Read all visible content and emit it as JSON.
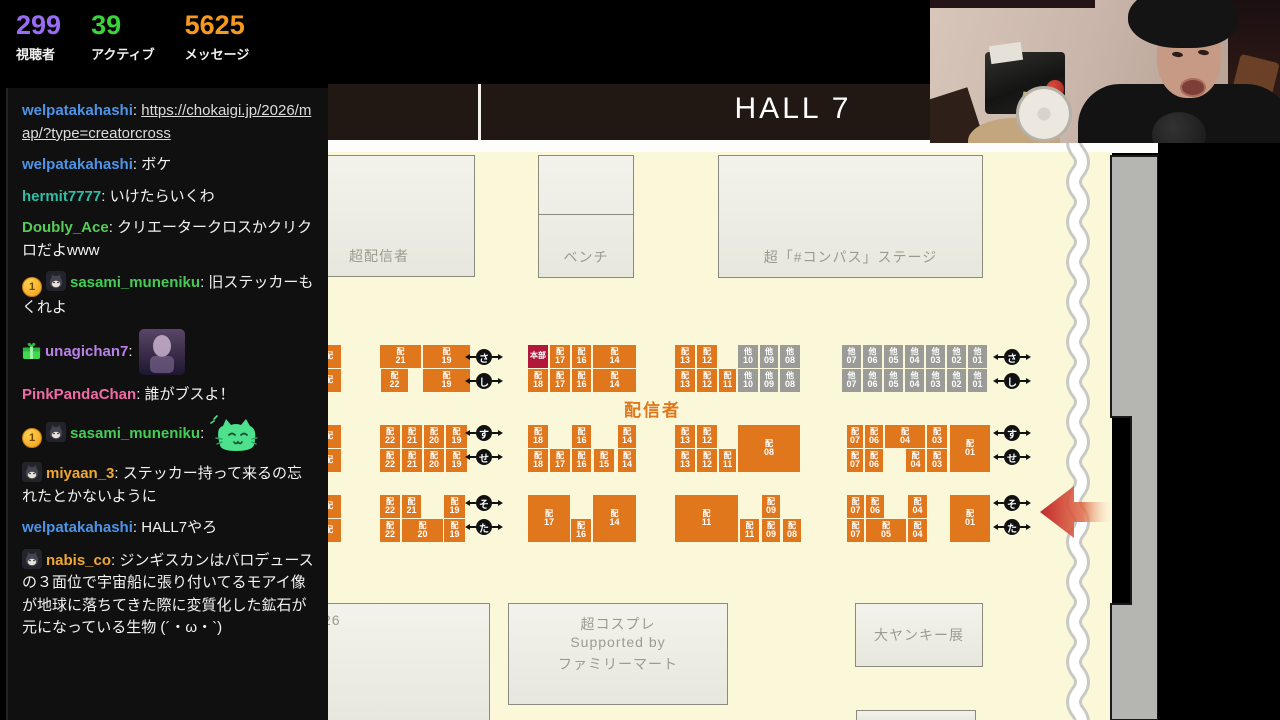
{
  "stats": {
    "viewers": "299",
    "viewers_label": "視聴者",
    "viewers_color": "#9a6cf5",
    "active": "39",
    "active_label": "アクティブ",
    "active_color": "#38d438",
    "messages": "5625",
    "messages_label": "メッセージ",
    "messages_color": "#f59a1e"
  },
  "chat": {
    "messages": [
      {
        "user": "welpatakahashi",
        "color": "#4d94e8",
        "link": "https://chokaigi.jp/2026/map/?type=creatorcross"
      },
      {
        "user": "welpatakahashi",
        "color": "#4d94e8",
        "text": "ボケ"
      },
      {
        "user": "hermit7777",
        "color": "#2fbfa6",
        "text": "いけたらいくわ"
      },
      {
        "user": "Doubly_Ace",
        "color": "#55cc55",
        "text": "クリエータークロスかクリクロだよwww"
      },
      {
        "user": "sasami_muneniku",
        "color": "#44cc55",
        "badges": [
          "coin",
          "cat"
        ],
        "text": "旧ステッカーもくれよ"
      },
      {
        "user": "unagichan7",
        "color": "#b982e6",
        "badges": [
          "gift"
        ],
        "emote": "purple"
      },
      {
        "user": "PinkPandaChan",
        "color": "#f06ba8",
        "text": "誰がブスよ！"
      },
      {
        "user": "sasami_muneniku",
        "color": "#44cc55",
        "badges": [
          "coin",
          "cat"
        ],
        "emote": "greencat"
      },
      {
        "user": "miyaan_3",
        "color": "#f0a832",
        "badges": [
          "cat"
        ],
        "text": "ステッカー持って来るの忘れたとかないように"
      },
      {
        "user": "welpatakahashi",
        "color": "#4d94e8",
        "text": "HALL7やろ"
      },
      {
        "user": "nabis_co",
        "color": "#f0a832",
        "badges": [
          "cat"
        ],
        "text": "ジンギスカンはパロデュースの３面位で宇宙船に張り付いてるモアイ像が地球に落ちてきた際に変質化した鉱石が元になっている生物 (´・ω・`)"
      }
    ],
    "coin_badge_label": "1"
  },
  "map": {
    "hall_title": "HALL 7",
    "haishinsha_label": "配信者",
    "colors": {
      "booth_orange": "#e0771c",
      "booth_gray": "#9b9b97",
      "hq_red": "#b2173a",
      "floor_cream": "#faf8d9"
    },
    "areas": [
      {
        "x": -12,
        "y": 155,
        "w": 159,
        "h": 122,
        "lines": [
          "超配信者"
        ],
        "pos": "bl"
      },
      {
        "x": 210,
        "y": 155,
        "w": 96,
        "h": 123,
        "lines": [
          "ベンチ"
        ],
        "pos": "bc",
        "divider": 58
      },
      {
        "x": 390,
        "y": 155,
        "w": 265,
        "h": 123,
        "lines": [
          "超「#コンパス」ステージ"
        ],
        "pos": "bc"
      },
      {
        "x": -12,
        "y": 603,
        "w": 174,
        "h": 120,
        "lines": [
          "26"
        ],
        "pos": "tl"
      },
      {
        "x": 180,
        "y": 603,
        "w": 220,
        "h": 102,
        "lines": [
          "超コスプレ",
          "Supported by",
          "ファミリーマート"
        ],
        "pos": "tc"
      },
      {
        "x": 527,
        "y": 603,
        "w": 128,
        "h": 64,
        "lines": [
          "大ヤンキー展"
        ],
        "pos": "c"
      },
      {
        "x": 528,
        "y": 710,
        "w": 120,
        "h": 14,
        "lines": [],
        "pos": "c"
      }
    ],
    "booths": [
      {
        "x": -11,
        "y": 345,
        "w": 24,
        "h": 23,
        "p": "配",
        "n": "",
        "t": "o"
      },
      {
        "x": -11,
        "y": 369,
        "w": 24,
        "h": 23,
        "p": "配",
        "n": "",
        "t": "o"
      },
      {
        "x": 52,
        "y": 345,
        "w": 41,
        "h": 23,
        "p": "配",
        "n": "21",
        "t": "o"
      },
      {
        "x": 95,
        "y": 345,
        "w": 47,
        "h": 23,
        "p": "配",
        "n": "19",
        "t": "o"
      },
      {
        "x": 53,
        "y": 369,
        "w": 27,
        "h": 23,
        "p": "配",
        "n": "22",
        "t": "o"
      },
      {
        "x": 95,
        "y": 369,
        "w": 47,
        "h": 23,
        "p": "配",
        "n": "19",
        "t": "o"
      },
      {
        "x": 200,
        "y": 345,
        "w": 20,
        "h": 23,
        "p": "本部",
        "n": "",
        "t": "r"
      },
      {
        "x": 222,
        "y": 345,
        "w": 20,
        "h": 23,
        "p": "配",
        "n": "17",
        "t": "o"
      },
      {
        "x": 244,
        "y": 345,
        "w": 19,
        "h": 23,
        "p": "配",
        "n": "16",
        "t": "o"
      },
      {
        "x": 265,
        "y": 345,
        "w": 43,
        "h": 23,
        "p": "配",
        "n": "14",
        "t": "o"
      },
      {
        "x": 200,
        "y": 369,
        "w": 20,
        "h": 23,
        "p": "配",
        "n": "18",
        "t": "o"
      },
      {
        "x": 222,
        "y": 369,
        "w": 20,
        "h": 23,
        "p": "配",
        "n": "17",
        "t": "o"
      },
      {
        "x": 244,
        "y": 369,
        "w": 19,
        "h": 23,
        "p": "配",
        "n": "16",
        "t": "o"
      },
      {
        "x": 265,
        "y": 369,
        "w": 43,
        "h": 23,
        "p": "配",
        "n": "14",
        "t": "o"
      },
      {
        "x": 347,
        "y": 345,
        "w": 20,
        "h": 23,
        "p": "配",
        "n": "13",
        "t": "o"
      },
      {
        "x": 369,
        "y": 345,
        "w": 20,
        "h": 23,
        "p": "配",
        "n": "12",
        "t": "o"
      },
      {
        "x": 410,
        "y": 345,
        "w": 20,
        "h": 23,
        "p": "他",
        "n": "10",
        "t": "g"
      },
      {
        "x": 432,
        "y": 345,
        "w": 18,
        "h": 23,
        "p": "他",
        "n": "09",
        "t": "g"
      },
      {
        "x": 452,
        "y": 345,
        "w": 20,
        "h": 23,
        "p": "他",
        "n": "08",
        "t": "g"
      },
      {
        "x": 347,
        "y": 369,
        "w": 20,
        "h": 23,
        "p": "配",
        "n": "13",
        "t": "o"
      },
      {
        "x": 369,
        "y": 369,
        "w": 20,
        "h": 23,
        "p": "配",
        "n": "12",
        "t": "o"
      },
      {
        "x": 391,
        "y": 369,
        "w": 17,
        "h": 23,
        "p": "配",
        "n": "11",
        "t": "o"
      },
      {
        "x": 410,
        "y": 369,
        "w": 20,
        "h": 23,
        "p": "他",
        "n": "10",
        "t": "g"
      },
      {
        "x": 432,
        "y": 369,
        "w": 18,
        "h": 23,
        "p": "他",
        "n": "09",
        "t": "g"
      },
      {
        "x": 452,
        "y": 369,
        "w": 20,
        "h": 23,
        "p": "他",
        "n": "08",
        "t": "g"
      },
      {
        "x": 514,
        "y": 345,
        "w": 19,
        "h": 23,
        "p": "他",
        "n": "07",
        "t": "g"
      },
      {
        "x": 535,
        "y": 345,
        "w": 19,
        "h": 23,
        "p": "他",
        "n": "06",
        "t": "g"
      },
      {
        "x": 556,
        "y": 345,
        "w": 19,
        "h": 23,
        "p": "他",
        "n": "05",
        "t": "g"
      },
      {
        "x": 577,
        "y": 345,
        "w": 19,
        "h": 23,
        "p": "他",
        "n": "04",
        "t": "g"
      },
      {
        "x": 598,
        "y": 345,
        "w": 19,
        "h": 23,
        "p": "他",
        "n": "03",
        "t": "g"
      },
      {
        "x": 619,
        "y": 345,
        "w": 19,
        "h": 23,
        "p": "他",
        "n": "02",
        "t": "g"
      },
      {
        "x": 640,
        "y": 345,
        "w": 19,
        "h": 23,
        "p": "他",
        "n": "01",
        "t": "g"
      },
      {
        "x": 514,
        "y": 369,
        "w": 19,
        "h": 23,
        "p": "他",
        "n": "07",
        "t": "g"
      },
      {
        "x": 535,
        "y": 369,
        "w": 19,
        "h": 23,
        "p": "他",
        "n": "06",
        "t": "g"
      },
      {
        "x": 556,
        "y": 369,
        "w": 19,
        "h": 23,
        "p": "他",
        "n": "05",
        "t": "g"
      },
      {
        "x": 577,
        "y": 369,
        "w": 19,
        "h": 23,
        "p": "他",
        "n": "04",
        "t": "g"
      },
      {
        "x": 598,
        "y": 369,
        "w": 19,
        "h": 23,
        "p": "他",
        "n": "03",
        "t": "g"
      },
      {
        "x": 619,
        "y": 369,
        "w": 19,
        "h": 23,
        "p": "他",
        "n": "02",
        "t": "g"
      },
      {
        "x": 640,
        "y": 369,
        "w": 19,
        "h": 23,
        "p": "他",
        "n": "01",
        "t": "g"
      },
      {
        "x": -11,
        "y": 425,
        "w": 24,
        "h": 23,
        "p": "配",
        "n": "",
        "t": "o"
      },
      {
        "x": -11,
        "y": 449,
        "w": 24,
        "h": 23,
        "p": "配",
        "n": "",
        "t": "o"
      },
      {
        "x": 52,
        "y": 425,
        "w": 20,
        "h": 23,
        "p": "配",
        "n": "22",
        "t": "o"
      },
      {
        "x": 74,
        "y": 425,
        "w": 20,
        "h": 23,
        "p": "配",
        "n": "21",
        "t": "o"
      },
      {
        "x": 96,
        "y": 425,
        "w": 20,
        "h": 23,
        "p": "配",
        "n": "20",
        "t": "o"
      },
      {
        "x": 118,
        "y": 425,
        "w": 21,
        "h": 23,
        "p": "配",
        "n": "19",
        "t": "o"
      },
      {
        "x": 52,
        "y": 449,
        "w": 20,
        "h": 23,
        "p": "配",
        "n": "22",
        "t": "o"
      },
      {
        "x": 74,
        "y": 449,
        "w": 20,
        "h": 23,
        "p": "配",
        "n": "21",
        "t": "o"
      },
      {
        "x": 96,
        "y": 449,
        "w": 20,
        "h": 23,
        "p": "配",
        "n": "20",
        "t": "o"
      },
      {
        "x": 118,
        "y": 449,
        "w": 21,
        "h": 23,
        "p": "配",
        "n": "19",
        "t": "o"
      },
      {
        "x": 200,
        "y": 425,
        "w": 20,
        "h": 23,
        "p": "配",
        "n": "18",
        "t": "o"
      },
      {
        "x": 244,
        "y": 425,
        "w": 19,
        "h": 23,
        "p": "配",
        "n": "16",
        "t": "o"
      },
      {
        "x": 290,
        "y": 425,
        "w": 18,
        "h": 23,
        "p": "配",
        "n": "14",
        "t": "o"
      },
      {
        "x": 200,
        "y": 449,
        "w": 20,
        "h": 23,
        "p": "配",
        "n": "18",
        "t": "o"
      },
      {
        "x": 222,
        "y": 449,
        "w": 20,
        "h": 23,
        "p": "配",
        "n": "17",
        "t": "o"
      },
      {
        "x": 244,
        "y": 449,
        "w": 19,
        "h": 23,
        "p": "配",
        "n": "16",
        "t": "o"
      },
      {
        "x": 266,
        "y": 449,
        "w": 20,
        "h": 23,
        "p": "配",
        "n": "15",
        "t": "o"
      },
      {
        "x": 290,
        "y": 449,
        "w": 18,
        "h": 23,
        "p": "配",
        "n": "14",
        "t": "o"
      },
      {
        "x": 347,
        "y": 425,
        "w": 20,
        "h": 23,
        "p": "配",
        "n": "13",
        "t": "o"
      },
      {
        "x": 369,
        "y": 425,
        "w": 20,
        "h": 23,
        "p": "配",
        "n": "12",
        "t": "o"
      },
      {
        "x": 410,
        "y": 425,
        "w": 62,
        "h": 47,
        "p": "配",
        "n": "08",
        "t": "o"
      },
      {
        "x": 347,
        "y": 449,
        "w": 20,
        "h": 23,
        "p": "配",
        "n": "13",
        "t": "o"
      },
      {
        "x": 369,
        "y": 449,
        "w": 20,
        "h": 23,
        "p": "配",
        "n": "12",
        "t": "o"
      },
      {
        "x": 391,
        "y": 449,
        "w": 17,
        "h": 23,
        "p": "配",
        "n": "11",
        "t": "o"
      },
      {
        "x": 519,
        "y": 425,
        "w": 16,
        "h": 23,
        "p": "配",
        "n": "07",
        "t": "o"
      },
      {
        "x": 537,
        "y": 425,
        "w": 18,
        "h": 23,
        "p": "配",
        "n": "06",
        "t": "o"
      },
      {
        "x": 557,
        "y": 425,
        "w": 40,
        "h": 23,
        "p": "配",
        "n": "04",
        "t": "o"
      },
      {
        "x": 599,
        "y": 425,
        "w": 20,
        "h": 23,
        "p": "配",
        "n": "03",
        "t": "o"
      },
      {
        "x": 622,
        "y": 425,
        "w": 40,
        "h": 47,
        "p": "配",
        "n": "01",
        "t": "o"
      },
      {
        "x": 519,
        "y": 449,
        "w": 16,
        "h": 23,
        "p": "配",
        "n": "07",
        "t": "o"
      },
      {
        "x": 537,
        "y": 449,
        "w": 18,
        "h": 23,
        "p": "配",
        "n": "06",
        "t": "o"
      },
      {
        "x": 578,
        "y": 449,
        "w": 19,
        "h": 23,
        "p": "配",
        "n": "04",
        "t": "o"
      },
      {
        "x": 599,
        "y": 449,
        "w": 20,
        "h": 23,
        "p": "配",
        "n": "03",
        "t": "o"
      },
      {
        "x": -11,
        "y": 495,
        "w": 24,
        "h": 23,
        "p": "配",
        "n": "",
        "t": "o"
      },
      {
        "x": -11,
        "y": 519,
        "w": 24,
        "h": 23,
        "p": "配",
        "n": "",
        "t": "o"
      },
      {
        "x": 52,
        "y": 495,
        "w": 20,
        "h": 23,
        "p": "配",
        "n": "22",
        "t": "o"
      },
      {
        "x": 74,
        "y": 495,
        "w": 19,
        "h": 23,
        "p": "配",
        "n": "21",
        "t": "o"
      },
      {
        "x": 116,
        "y": 495,
        "w": 21,
        "h": 23,
        "p": "配",
        "n": "19",
        "t": "o"
      },
      {
        "x": 52,
        "y": 519,
        "w": 20,
        "h": 23,
        "p": "配",
        "n": "22",
        "t": "o"
      },
      {
        "x": 74,
        "y": 519,
        "w": 41,
        "h": 23,
        "p": "配",
        "n": "20",
        "t": "o"
      },
      {
        "x": 116,
        "y": 519,
        "w": 21,
        "h": 23,
        "p": "配",
        "n": "19",
        "t": "o"
      },
      {
        "x": 200,
        "y": 495,
        "w": 42,
        "h": 47,
        "p": "配",
        "n": "17",
        "t": "o"
      },
      {
        "x": 243,
        "y": 519,
        "w": 20,
        "h": 23,
        "p": "配",
        "n": "16",
        "t": "o"
      },
      {
        "x": 265,
        "y": 495,
        "w": 43,
        "h": 47,
        "p": "配",
        "n": "14",
        "t": "o"
      },
      {
        "x": 347,
        "y": 495,
        "w": 63,
        "h": 47,
        "p": "配",
        "n": "11",
        "t": "o"
      },
      {
        "x": 434,
        "y": 495,
        "w": 18,
        "h": 23,
        "p": "配",
        "n": "09",
        "t": "o"
      },
      {
        "x": 412,
        "y": 519,
        "w": 19,
        "h": 23,
        "p": "配",
        "n": "11",
        "t": "o"
      },
      {
        "x": 434,
        "y": 519,
        "w": 18,
        "h": 23,
        "p": "配",
        "n": "09",
        "t": "o"
      },
      {
        "x": 455,
        "y": 519,
        "w": 18,
        "h": 23,
        "p": "配",
        "n": "08",
        "t": "o"
      },
      {
        "x": 519,
        "y": 495,
        "w": 17,
        "h": 23,
        "p": "配",
        "n": "07",
        "t": "o"
      },
      {
        "x": 538,
        "y": 495,
        "w": 18,
        "h": 23,
        "p": "配",
        "n": "06",
        "t": "o"
      },
      {
        "x": 580,
        "y": 495,
        "w": 19,
        "h": 23,
        "p": "配",
        "n": "04",
        "t": "o"
      },
      {
        "x": 622,
        "y": 495,
        "w": 40,
        "h": 47,
        "p": "配",
        "n": "01",
        "t": "o"
      },
      {
        "x": 519,
        "y": 519,
        "w": 17,
        "h": 23,
        "p": "配",
        "n": "07",
        "t": "o"
      },
      {
        "x": 538,
        "y": 519,
        "w": 40,
        "h": 23,
        "p": "配",
        "n": "05",
        "t": "o"
      },
      {
        "x": 580,
        "y": 519,
        "w": 19,
        "h": 23,
        "p": "配",
        "n": "04",
        "t": "o"
      }
    ],
    "markers": [
      {
        "x": 156,
        "y": 357,
        "c": "さ"
      },
      {
        "x": 156,
        "y": 381,
        "c": "し"
      },
      {
        "x": 156,
        "y": 433,
        "c": "す"
      },
      {
        "x": 156,
        "y": 457,
        "c": "せ"
      },
      {
        "x": 156,
        "y": 503,
        "c": "そ"
      },
      {
        "x": 156,
        "y": 527,
        "c": "た"
      },
      {
        "x": 684,
        "y": 357,
        "c": "さ"
      },
      {
        "x": 684,
        "y": 381,
        "c": "し"
      },
      {
        "x": 684,
        "y": 433,
        "c": "す"
      },
      {
        "x": 684,
        "y": 457,
        "c": "せ"
      },
      {
        "x": 684,
        "y": 503,
        "c": "そ"
      },
      {
        "x": 684,
        "y": 527,
        "c": "た"
      }
    ]
  }
}
